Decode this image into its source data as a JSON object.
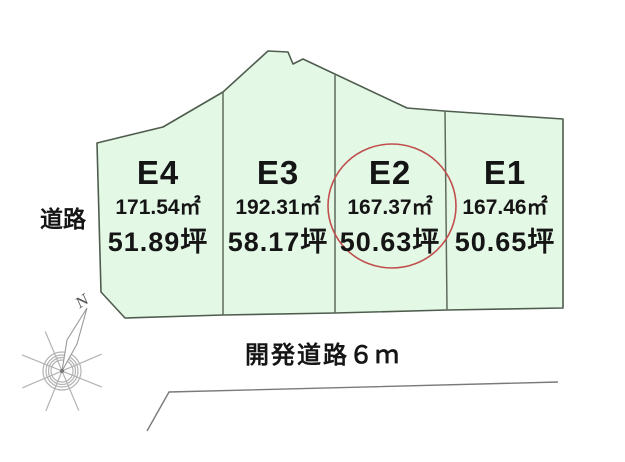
{
  "plots": [
    {
      "id": "E4",
      "area_m2": "171.54㎡",
      "area_tsubo": "51.89坪",
      "highlighted": false
    },
    {
      "id": "E3",
      "area_m2": "192.31㎡",
      "area_tsubo": "58.17坪",
      "highlighted": false
    },
    {
      "id": "E2",
      "area_m2": "167.37㎡",
      "area_tsubo": "50.63坪",
      "highlighted": true
    },
    {
      "id": "E1",
      "area_m2": "167.46㎡",
      "area_tsubo": "50.65坪",
      "highlighted": false
    }
  ],
  "labels": {
    "left_road": "道路",
    "bottom_road": "開発道路６ｍ",
    "compass_north": "N"
  },
  "colors": {
    "plot_fill": "#e4f8e6",
    "plot_border": "#4f5d4f",
    "divider": "#5f6b5f",
    "highlight_circle": "#c0504d",
    "text": "#151515",
    "road_line": "#7a7a7a",
    "compass": "#b3b3b3",
    "bg": "#ffffff"
  }
}
